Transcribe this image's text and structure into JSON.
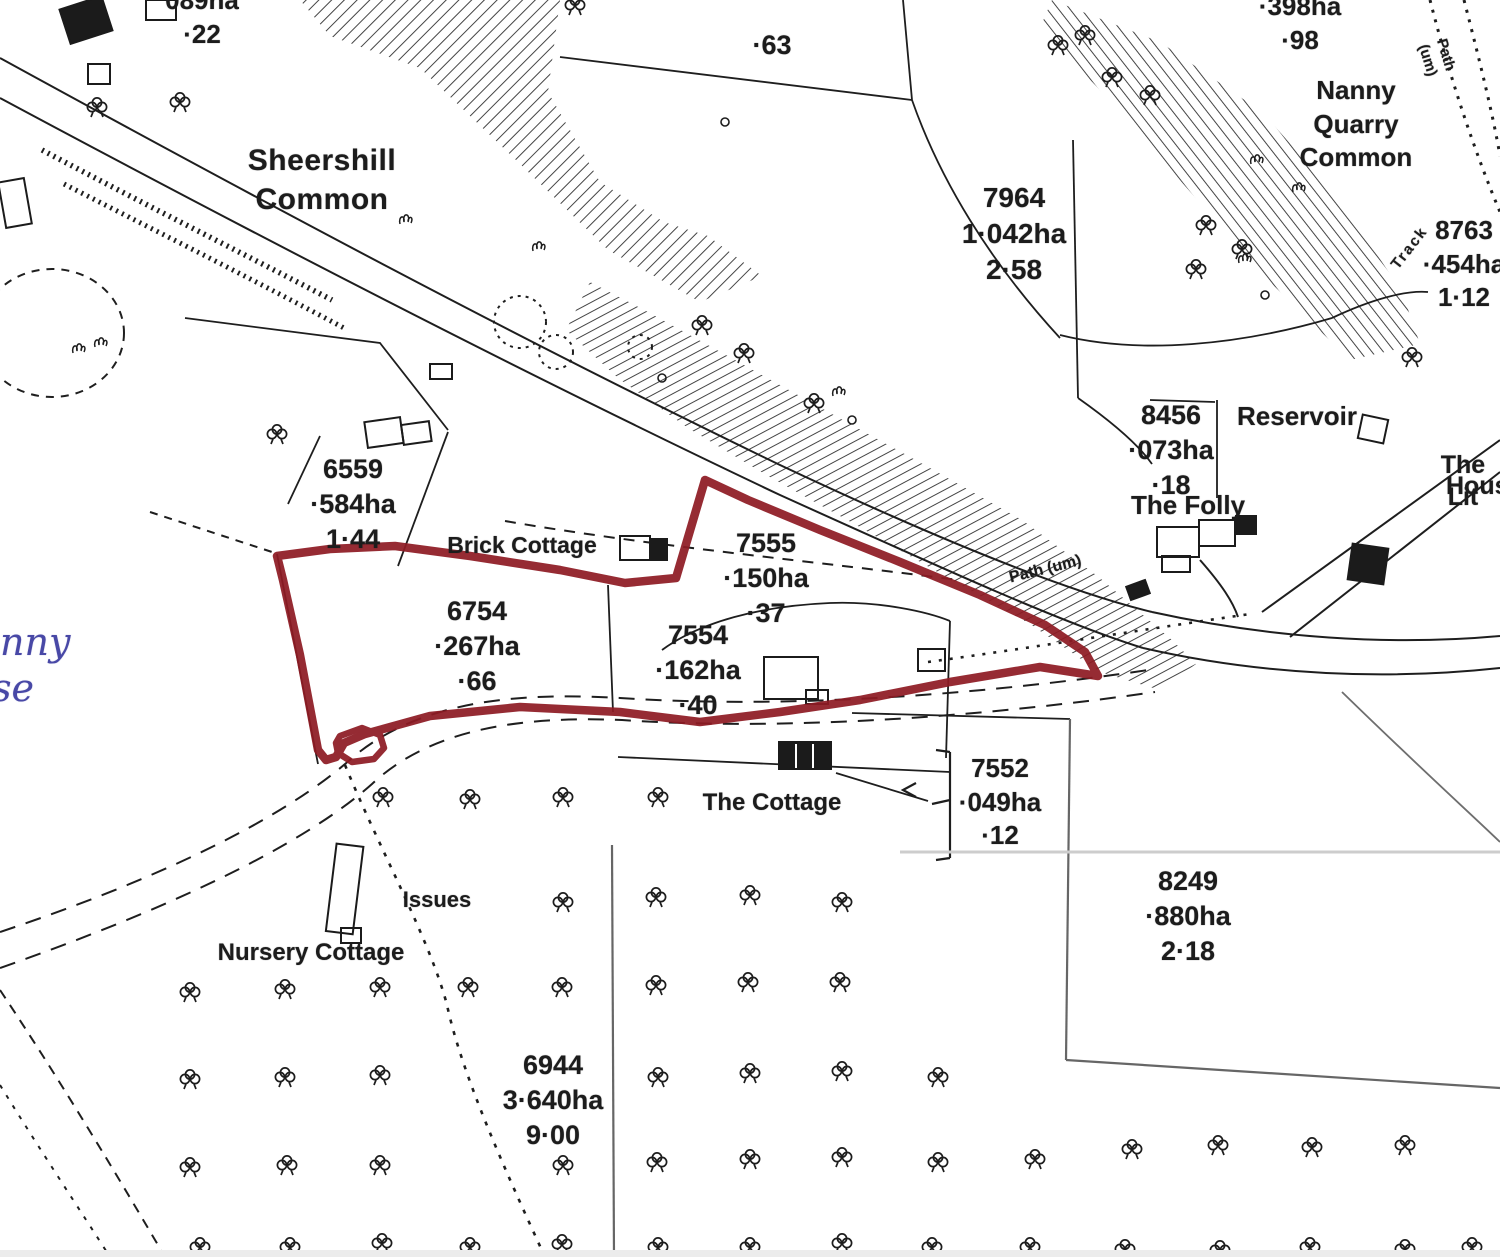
{
  "map": {
    "type": "scanned land-registry plan",
    "background": "#ffffff",
    "line_color": "#1e1e1e",
    "faint_line_color": "#8f8f8f",
    "red_boundary_color": "#8e1b24",
    "handwriting_color": "#4848a6"
  },
  "place_labels": [
    {
      "name": "label-sheershill-common",
      "text": "Sheershill\nCommon",
      "x": 322,
      "y": 142,
      "fs": 30,
      "fw": 700,
      "ls": 0.5
    },
    {
      "name": "label-nanny-quarry-common",
      "text": "Nanny Quarry\nCommon",
      "x": 1356,
      "y": 74,
      "fs": 26,
      "fw": 700
    },
    {
      "name": "label-brick-cottage",
      "text": "Brick Cottage",
      "x": 522,
      "y": 531,
      "fs": 23,
      "fw": 700
    },
    {
      "name": "label-the-folly",
      "text": "The Folly",
      "x": 1188,
      "y": 489,
      "fs": 26,
      "fw": 700
    },
    {
      "name": "label-reservoir",
      "text": "Reservoir",
      "x": 1297,
      "y": 400,
      "fs": 26,
      "fw": 700
    },
    {
      "name": "label-the-cottage",
      "text": "The Cottage",
      "x": 772,
      "y": 788,
      "fs": 24,
      "fw": 700
    },
    {
      "name": "label-nursery-cottage",
      "text": "Nursery Cottage",
      "x": 311,
      "y": 938,
      "fs": 24,
      "fw": 700
    },
    {
      "name": "label-issues",
      "text": "Issues",
      "x": 437,
      "y": 886,
      "fs": 22,
      "fw": 700
    },
    {
      "name": "label-the-little-house-1",
      "text": "The Lit",
      "x": 1426,
      "y": 449,
      "fs": 25,
      "fw": 700,
      "align": "left"
    },
    {
      "name": "label-the-little-house-2",
      "text": "Hous",
      "x": 1446,
      "y": 470,
      "fs": 25,
      "fw": 700,
      "align": "left"
    },
    {
      "name": "label-path-um-mid",
      "text": "Path (um)",
      "x": 1043,
      "y": 560,
      "fs": 16,
      "fw": 700,
      "rot": -14
    },
    {
      "name": "label-path-um-right",
      "text": "Path (um)",
      "x": 1455,
      "y": 52,
      "fs": 15,
      "fw": 700,
      "rot": 73
    },
    {
      "name": "label-track",
      "text": "Track",
      "x": 1402,
      "y": 242,
      "fs": 15,
      "fw": 700,
      "rot": -52,
      "ls": 2
    }
  ],
  "parcels": [
    {
      "name": "parcel-089",
      "number": null,
      "area_ha": "089ha",
      "area_acres": "·22",
      "x": 202,
      "y": -16,
      "fs": 26
    },
    {
      "name": "parcel-63",
      "number": null,
      "area_ha": null,
      "area_acres": "·63",
      "x": 772,
      "y": 28,
      "fs": 27
    },
    {
      "name": "parcel-398",
      "number": null,
      "area_ha": "·398ha",
      "area_acres": "·98",
      "x": 1300,
      "y": -10,
      "fs": 26
    },
    {
      "name": "parcel-7964",
      "number": "7964",
      "area_ha": "1·042ha",
      "area_acres": "2·58",
      "x": 1014,
      "y": 180,
      "fs": 28
    },
    {
      "name": "parcel-8763",
      "number": "8763",
      "area_ha": "·454ha",
      "area_acres": "1·12",
      "x": 1464,
      "y": 214,
      "fs": 26
    },
    {
      "name": "parcel-8456",
      "number": "8456",
      "area_ha": "·073ha",
      "area_acres": "·18",
      "x": 1171,
      "y": 398,
      "fs": 27
    },
    {
      "name": "parcel-6559",
      "number": "6559",
      "area_ha": "·584ha",
      "area_acres": "1·44",
      "x": 353,
      "y": 452,
      "fs": 27
    },
    {
      "name": "parcel-6754",
      "number": "6754",
      "area_ha": "·267ha",
      "area_acres": "·66",
      "x": 477,
      "y": 594,
      "fs": 27
    },
    {
      "name": "parcel-7555",
      "number": "7555",
      "area_ha": "·150ha",
      "area_acres": "·37",
      "x": 766,
      "y": 526,
      "fs": 27
    },
    {
      "name": "parcel-7554",
      "number": "7554",
      "area_ha": "·162ha",
      "area_acres": "·40",
      "x": 698,
      "y": 618,
      "fs": 27
    },
    {
      "name": "parcel-7552",
      "number": "7552",
      "area_ha": "·049ha",
      "area_acres": "·12",
      "x": 1000,
      "y": 752,
      "fs": 26
    },
    {
      "name": "parcel-8249",
      "number": "8249",
      "area_ha": "·880ha",
      "area_acres": "2·18",
      "x": 1188,
      "y": 864,
      "fs": 27
    },
    {
      "name": "parcel-6944",
      "number": "6944",
      "area_ha": "3·640ha",
      "area_acres": "9·00",
      "x": 553,
      "y": 1048,
      "fs": 27
    }
  ],
  "handwriting": [
    {
      "name": "handwriting-nny",
      "text": "nny",
      "x": 0,
      "y": 622,
      "fs": 38
    },
    {
      "name": "handwriting-se",
      "text": "se",
      "x": -8,
      "y": 668,
      "fs": 38
    }
  ],
  "red_boundary": {
    "color": "#8e1b24",
    "outer_points": "277,556 330,549 395,546 470,556 560,570 625,583 676,578 705,480 748,500 820,530 900,562 980,595 1045,625 1085,652 1098,676 1040,667 950,682 860,700 780,712 700,722 620,712 520,707 430,716 365,734 344,743 336,757 326,760 318,750 300,655 283,580",
    "loop_points": "340,736 362,728 380,735 384,748 374,759 352,762 338,753 336,743"
  },
  "symbols": {
    "trees": [
      [
        383,
        800
      ],
      [
        470,
        802
      ],
      [
        563,
        800
      ],
      [
        658,
        800
      ],
      [
        563,
        905
      ],
      [
        656,
        900
      ],
      [
        750,
        898
      ],
      [
        842,
        905
      ],
      [
        190,
        995
      ],
      [
        285,
        992
      ],
      [
        380,
        990
      ],
      [
        468,
        990
      ],
      [
        562,
        990
      ],
      [
        656,
        988
      ],
      [
        748,
        985
      ],
      [
        840,
        985
      ],
      [
        190,
        1082
      ],
      [
        285,
        1080
      ],
      [
        380,
        1078
      ],
      [
        658,
        1080
      ],
      [
        750,
        1076
      ],
      [
        842,
        1074
      ],
      [
        938,
        1080
      ],
      [
        190,
        1170
      ],
      [
        287,
        1168
      ],
      [
        380,
        1168
      ],
      [
        563,
        1168
      ],
      [
        657,
        1165
      ],
      [
        750,
        1162
      ],
      [
        842,
        1160
      ],
      [
        938,
        1165
      ],
      [
        1035,
        1162
      ],
      [
        1132,
        1152
      ],
      [
        1218,
        1148
      ],
      [
        1312,
        1150
      ],
      [
        1405,
        1148
      ],
      [
        200,
        1250
      ],
      [
        290,
        1250
      ],
      [
        382,
        1246
      ],
      [
        470,
        1250
      ],
      [
        562,
        1247
      ],
      [
        658,
        1250
      ],
      [
        750,
        1250
      ],
      [
        842,
        1246
      ],
      [
        932,
        1250
      ],
      [
        1030,
        1250
      ],
      [
        1125,
        1252
      ],
      [
        1220,
        1253
      ],
      [
        1310,
        1250
      ],
      [
        1405,
        1252
      ],
      [
        1472,
        1250
      ],
      [
        180,
        105
      ],
      [
        97,
        110
      ],
      [
        277,
        437
      ],
      [
        575,
        8
      ],
      [
        702,
        328
      ],
      [
        744,
        356
      ],
      [
        814,
        406
      ],
      [
        1058,
        48
      ],
      [
        1085,
        38
      ],
      [
        1112,
        80
      ],
      [
        1150,
        98
      ],
      [
        1196,
        272
      ],
      [
        1206,
        228
      ],
      [
        1242,
        252
      ],
      [
        1412,
        360
      ]
    ],
    "tufts": [
      [
        405,
        218
      ],
      [
        538,
        245
      ],
      [
        838,
        390
      ],
      [
        78,
        347
      ],
      [
        100,
        341
      ],
      [
        1256,
        158
      ],
      [
        1298,
        186
      ],
      [
        1244,
        257
      ]
    ],
    "rings": [
      [
        725,
        122,
        4
      ],
      [
        662,
        378,
        4
      ],
      [
        852,
        420,
        4
      ],
      [
        1265,
        295,
        4
      ]
    ]
  }
}
